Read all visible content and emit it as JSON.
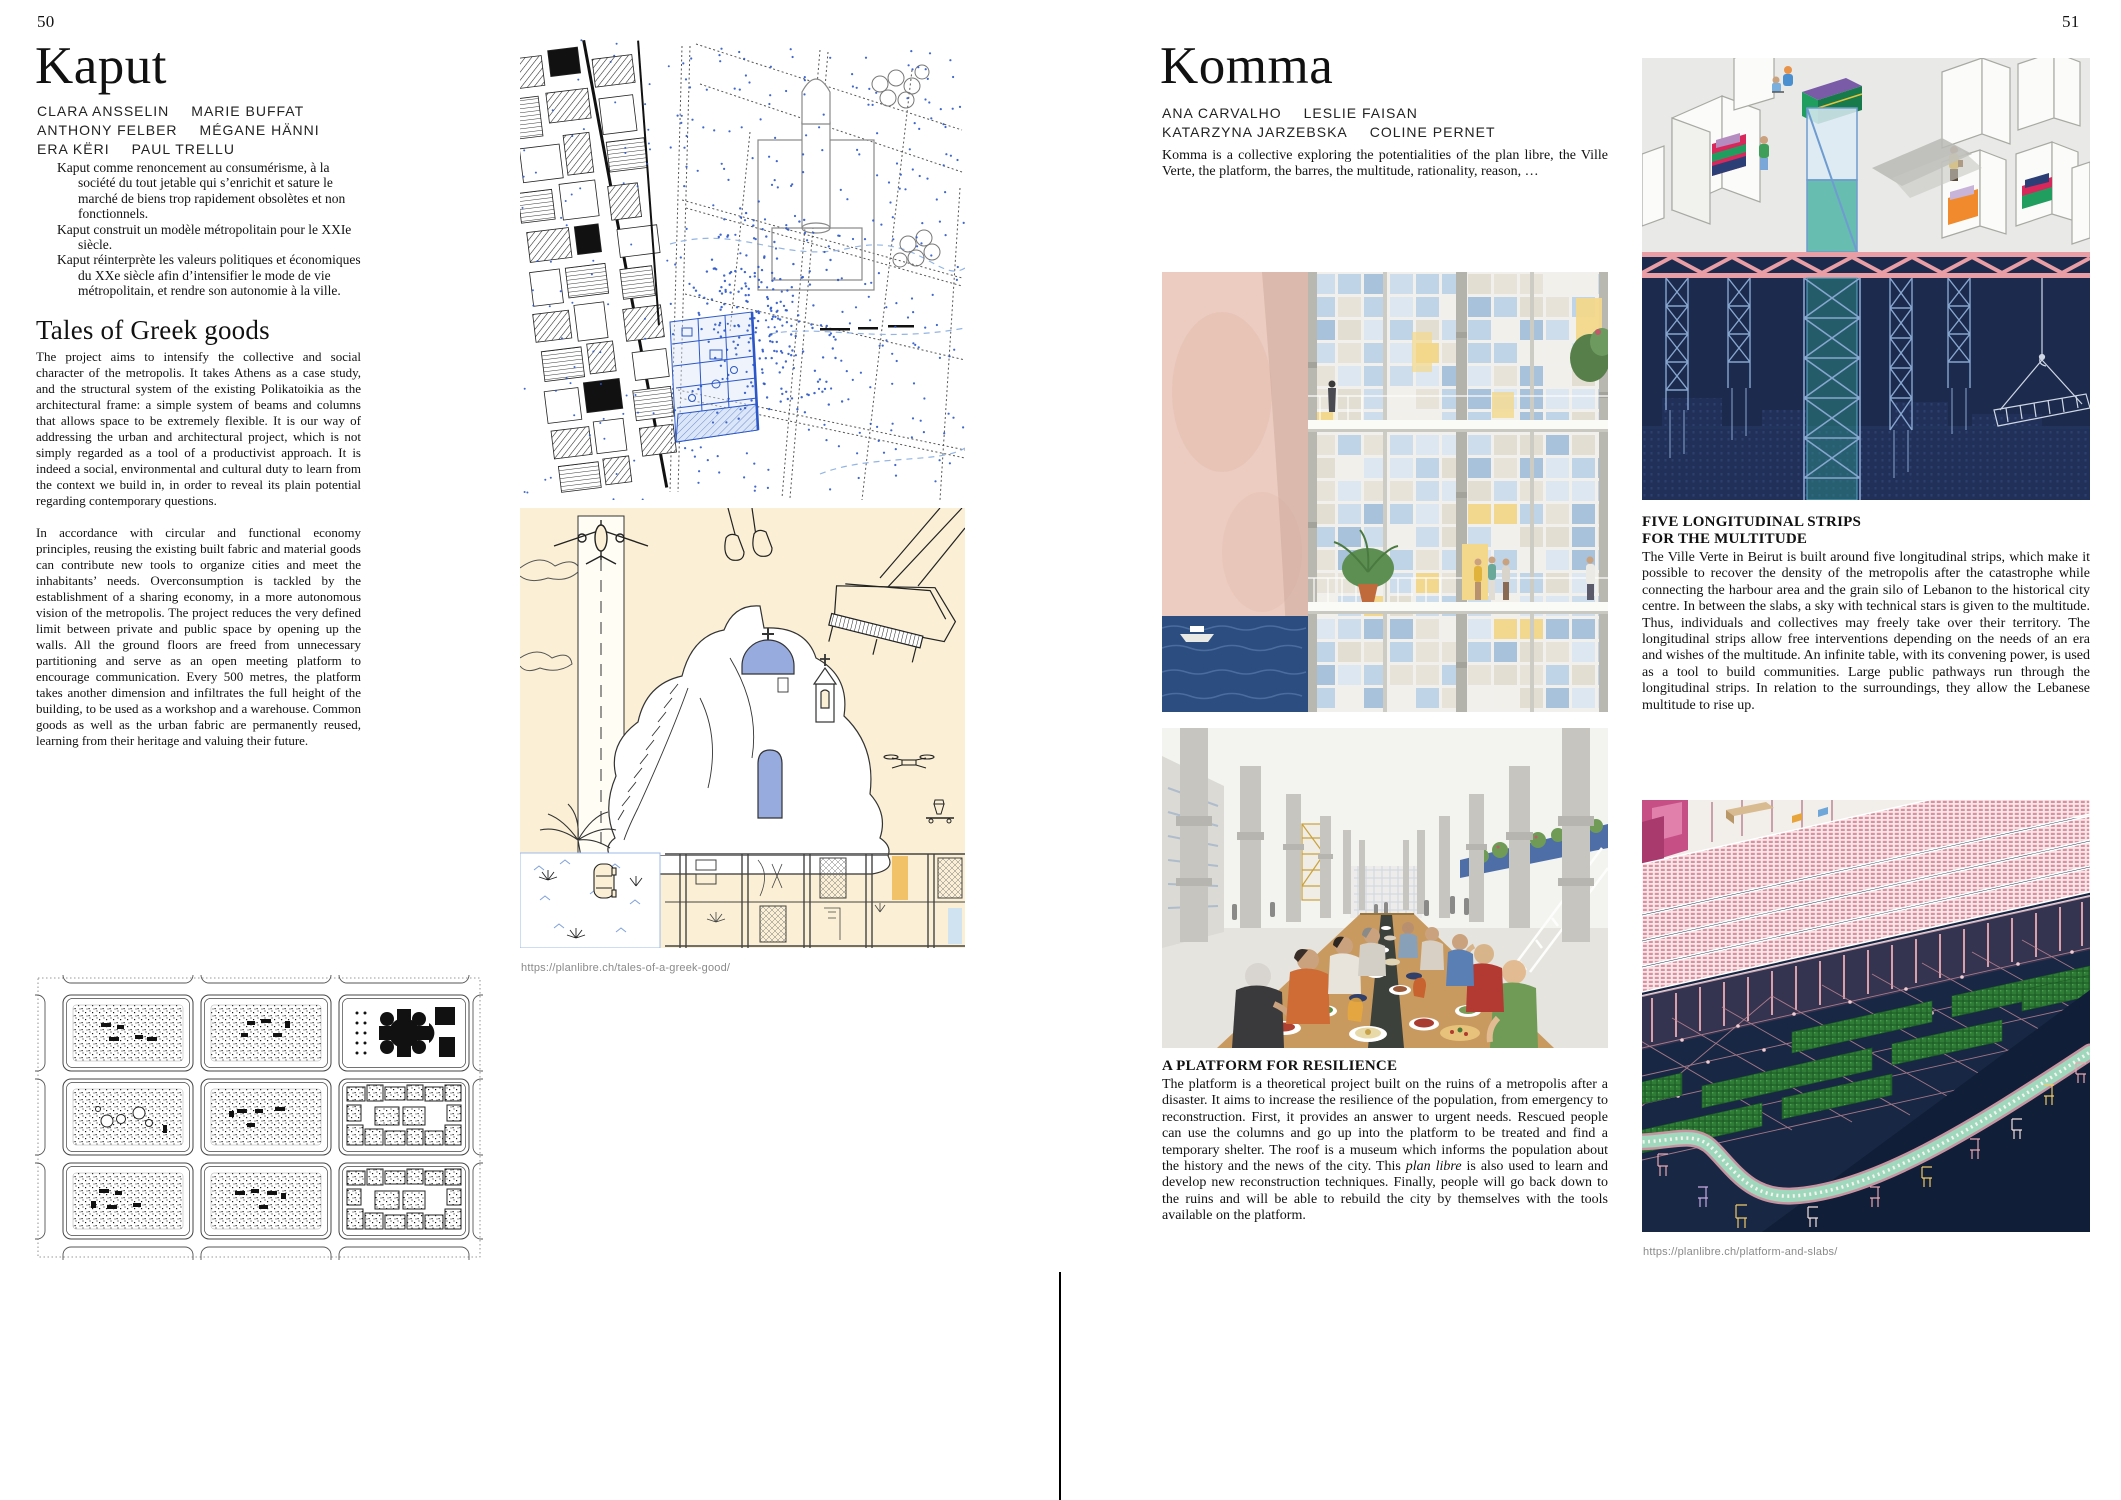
{
  "palette": {
    "map_dot_blue": "#2b57c8",
    "map_plan_blue": "#2b57c8",
    "cream_background": "#fbf0d6",
    "dome_blue": "#98abdf",
    "accent_orange": "#f2c268",
    "navy": "#1c2b4d",
    "truss_pink": "#e89ea4",
    "lattice_blue": "#87a6cf",
    "glass_teal": "#3aa396",
    "wall_pink": "#ecccc0",
    "sea_blue": "#2c4d80",
    "curtain_yellow": "#f3d88c",
    "field_green": "#2e7c35",
    "path_mint": "#9fd8bd",
    "iso_pink": "#dd8fa0"
  },
  "left_page": {
    "page_number": "50",
    "title": "Kaput",
    "author_lines": [
      [
        "CLARA ANSSELIN",
        "MARIE BUFFAT"
      ],
      [
        "ANTHONY FELBER",
        "MÉGANE HÄNNI"
      ],
      [
        "ERA KËRI",
        "PAUL TRELLU"
      ]
    ],
    "manifesto": [
      "Kaput comme renoncement au consumérisme, à la société du tout jetable qui s’enrichit et sature le marché de biens trop rapidement obsolètes et non fonctionnels.",
      "Kaput construit un modèle métropolitain pour le XXIe siècle.",
      "Kaput réinterprète les valeurs politiques et économiques du XXe siècle afin d’intensifier le mode de vie métropolitain, et rendre son autonomie à la ville."
    ],
    "section_heading": "Tales of Greek goods",
    "paragraphs": [
      "The project aims to intensify the collective and social character of the metropolis. It takes Athens as a case study, and the structural system of the existing Polikatoikia as the architectural frame: a simple system of beams and columns that allows space to be extremely flexible. It is our way of addressing the urban and architectural project, which is not simply regarded as a tool of a productivist approach. It is indeed a social, environmental and cultural duty to learn from the context we build in, in order to reveal its plain potential regarding contemporary questions.",
      "In accordance with circular and functional economy principles, reusing the existing built fabric and material goods can contribute new tools to organize cities and meet the inhabitants’ needs. Overconsumption is tackled by the establishment of a sharing economy, in a more autonomous vision of the metropolis. The project reduces the very defined limit between private and public space by opening up the walls. All the ground floors are freed from unnecessary partitioning and serve as an open meeting platform to encourage communication. Every 500 metres, the platform takes another dimension and infiltrates the full height of the building, to be used as a workshop and a warehouse. Common goods as well as the urban fabric are permanently reused, learning from their heritage and valuing their future."
    ],
    "figure_url": "https://planlibre.ch/tales-of-a-greek-good/"
  },
  "right_page": {
    "page_number": "51",
    "title": "Komma",
    "author_lines": [
      [
        "ANA CARVALHO",
        "LESLIE FAISAN"
      ],
      [
        "KATARZYNA JARZEBSKA",
        "COLINE PERNET"
      ]
    ],
    "intro": "Komma is a collective exploring the potentialities of the plan libre, the Ville Verte, the platform, the barres, the multitude, rationality, reason, …",
    "strips_section": {
      "heading_line1": "FIVE LONGITUDINAL STRIPS",
      "heading_line2": "FOR THE MULTITUDE",
      "body": "The Ville Verte in Beirut is built around five longitudinal strips, which make it possible to recover the density of the metropolis after the catastrophe while connecting the harbour area and the grain silo of Lebanon to the historical city centre. In between the slabs, a sky with technical stars is given to the multitude. Thus, individuals and collectives may freely take over their territory. The longitudinal strips allow free interventions depending on the needs of an era and wishes of the multitude. An infinite table, with its convening power, is used as a tool to build communities. Large public pathways run through the longitudinal strips. In relation to the surroundings, they allow the Lebanese multitude to rise up."
    },
    "platform_section": {
      "heading": "A PLATFORM FOR RESILIENCE",
      "body_pre": "The platform is a theoretical project built on the ruins of a metropolis after a disaster. It aims to increase the resilience of the population, from emergency to reconstruction. First, it provides an answer to urgent needs. Rescued people can use the columns and go up into the platform to be treated and find a temporary shelter. The roof is a museum which informs the population about the history and the news of the city. This ",
      "body_italic": "plan libre",
      "body_post": " is also used to learn and develop new reconstruction techniques. Finally, people will go back down to the ruins and will be able to rebuild the city by themselves with the tools available on the platform."
    },
    "figure_url": "https://planlibre.ch/platform-and-slabs/"
  }
}
